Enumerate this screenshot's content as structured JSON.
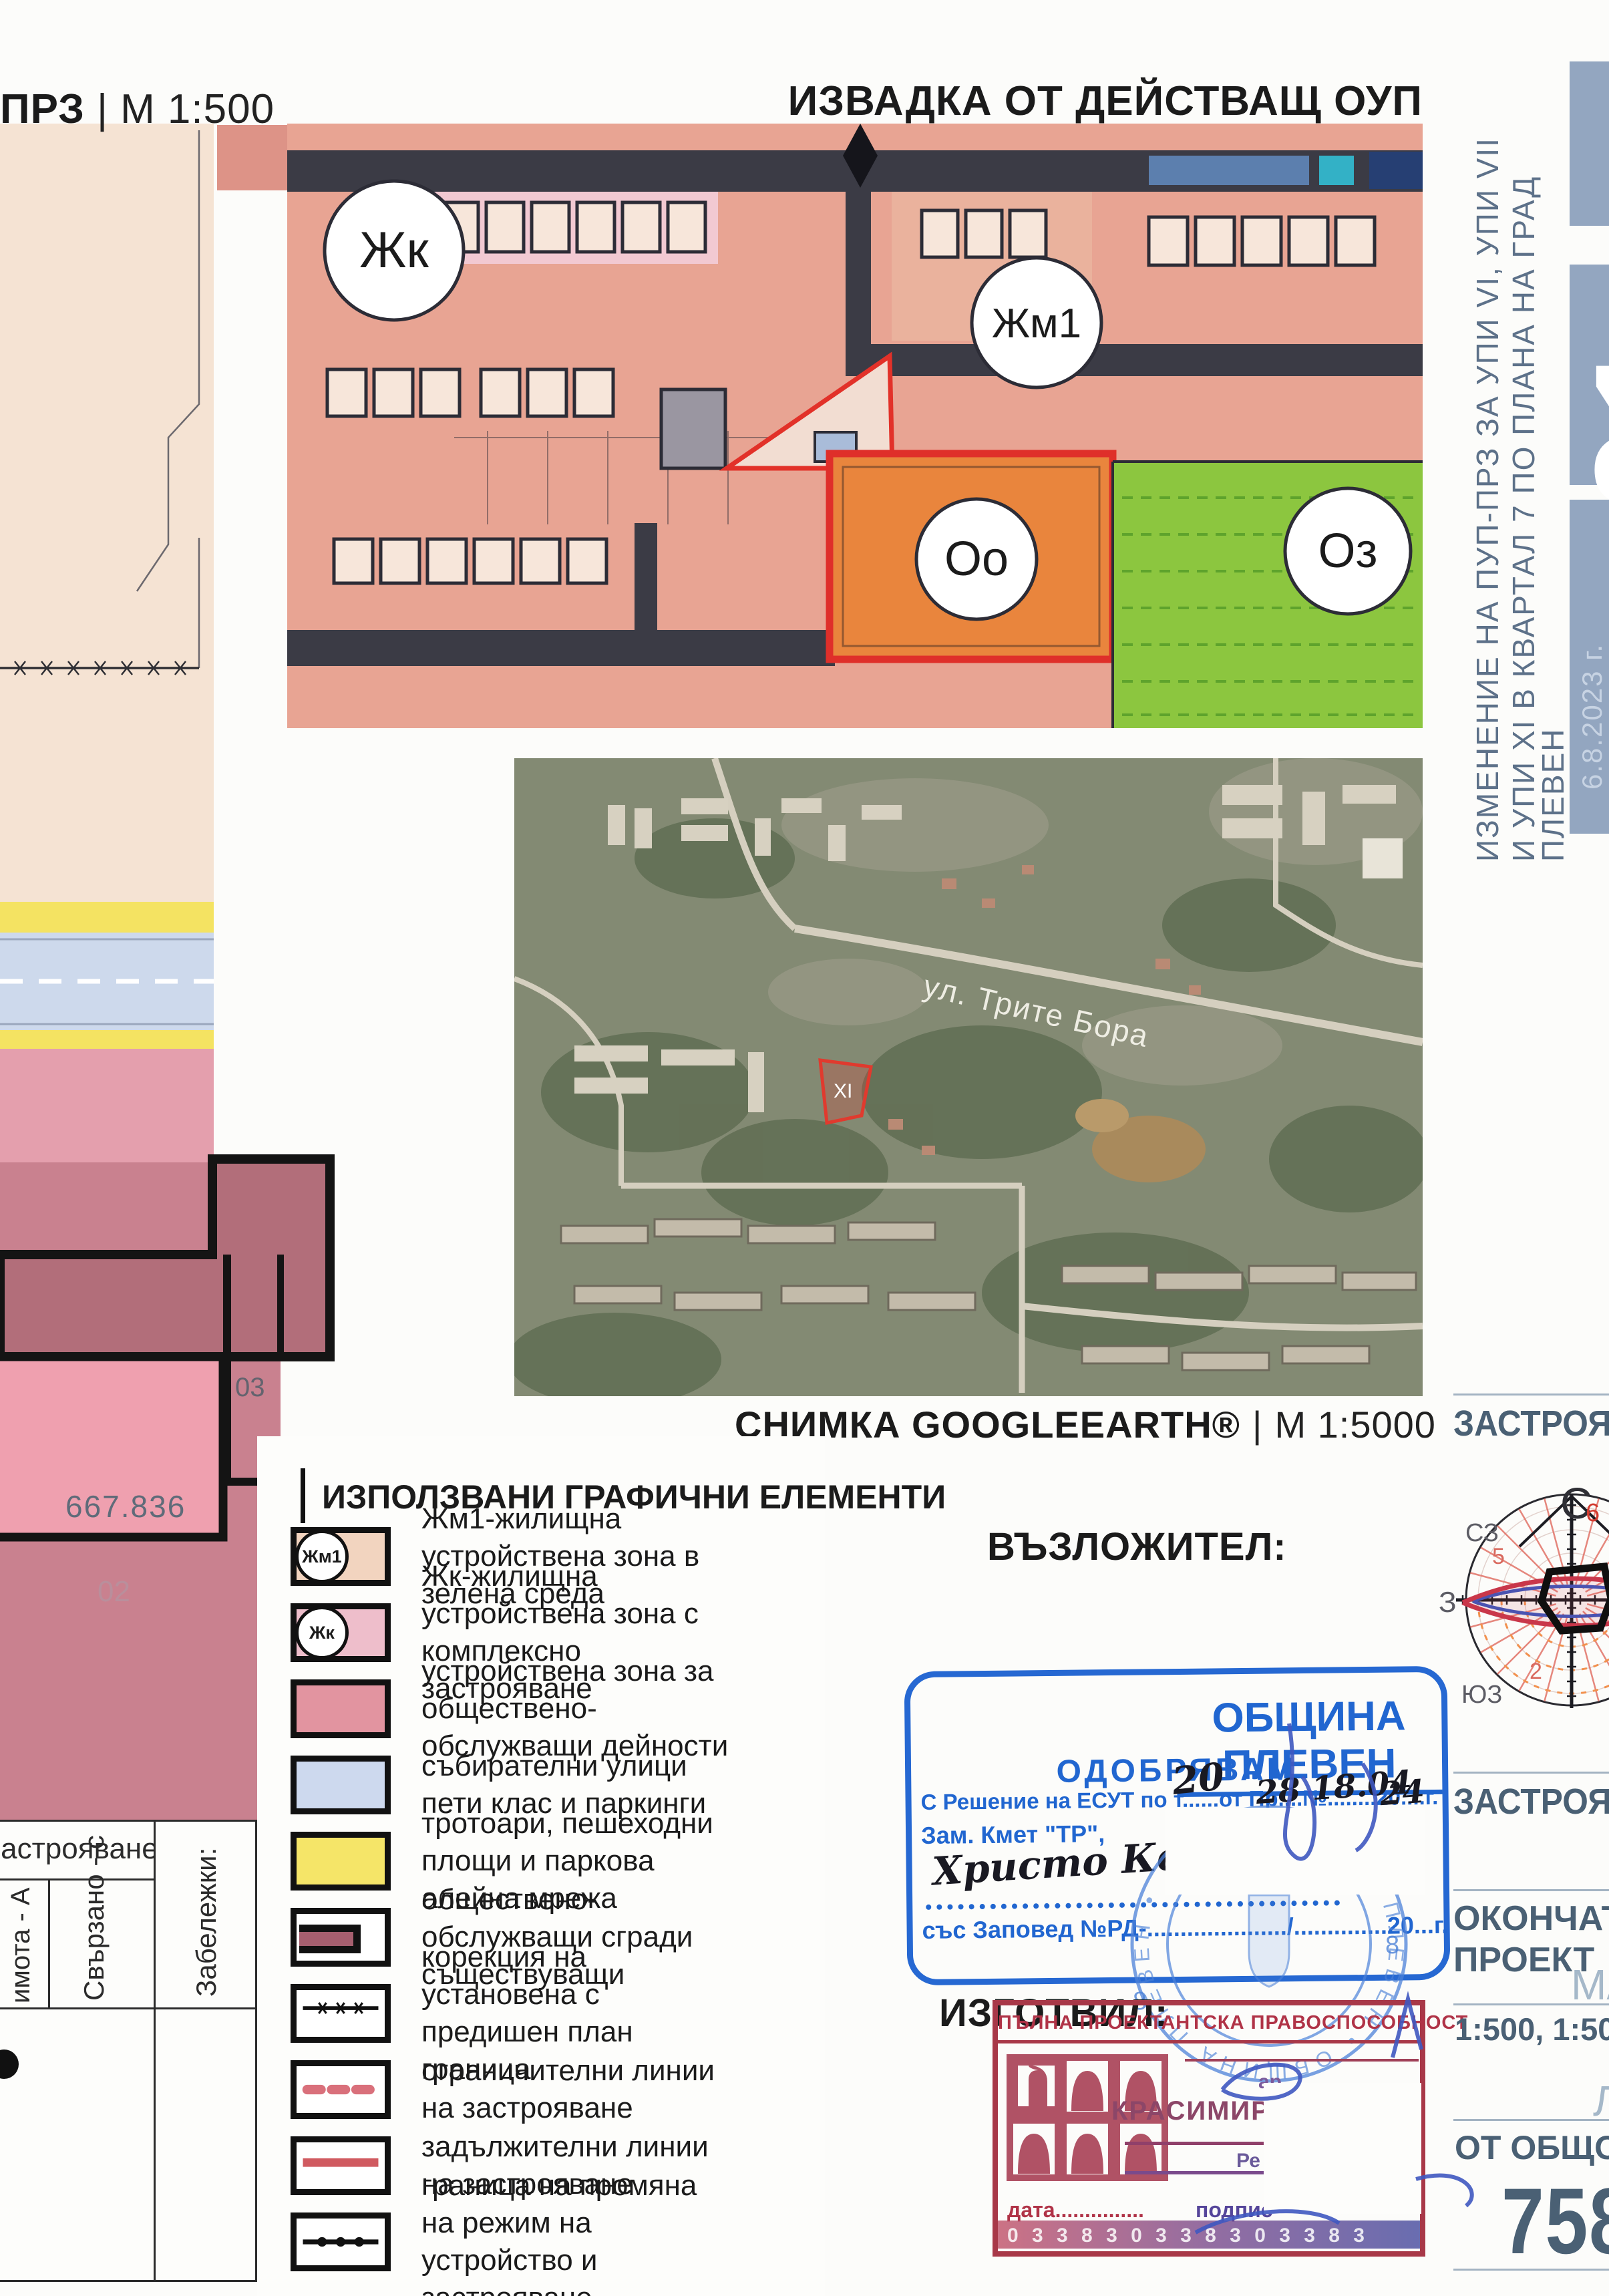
{
  "titles": {
    "plan": "ПРЗ",
    "plan_scale": "М 1:500",
    "sep": "|",
    "oup": "ИЗВАДКА ОТ ДЕЙСТВАЩ ОУП",
    "satellite": "СНИМКА GOOGLEEARTH®",
    "satellite_scale": "М 1:5000"
  },
  "oup_zones": {
    "zhk": "Жк",
    "zhm1": "Жм1",
    "oo": "Оо",
    "oz": "Оз"
  },
  "satellite": {
    "street": "ул. Трите Бора",
    "parcel": "XI"
  },
  "left_plan": {
    "area": "667.836",
    "p02": "02",
    "p03": "03"
  },
  "table": {
    "header": "застрояване",
    "col_a": "имота - А",
    "col_b": "Свързано - с",
    "notes": "Забележки:"
  },
  "sidebar": {
    "line1": "ИЗМЕНЕНИЕ НА ПУП-ПРЗ ЗА УПИ VI, УПИ VII",
    "line2": "И УПИ XI В КВАРТАЛ 7 ПО ПЛАНА НА ГРАД",
    "city": "ПЛЕВЕН",
    "sheet": "01",
    "date": "6.8.2023 г."
  },
  "legend": {
    "title": "ИЗПОЛЗВАНИ ГРАФИЧНИ ЕЛЕМЕНТИ",
    "items": [
      {
        "type": "zone-zhm1",
        "badge": "Жм1",
        "text": "Жм1-жилищна устройствена зона в зелена среда"
      },
      {
        "type": "zone-zhk",
        "badge": "Жк",
        "text": "Жк-жилищна устройствена зона с комплексно застрояване"
      },
      {
        "type": "zone-public",
        "text": "устройствена зона за обществено-обслужващи дейности"
      },
      {
        "type": "zone-street",
        "text": "събирателни улици пети клас и паркинги"
      },
      {
        "type": "zone-sidewalk",
        "text": "тротоари, пешеходни площи и паркова алейна мрежа"
      },
      {
        "type": "building",
        "text": "обществено-обслужващи сгради съществуващи"
      },
      {
        "type": "line-correction",
        "text": "корекция на установена с предишен план граница"
      },
      {
        "type": "line-restrict",
        "text": "ограничителни линии на застрояване"
      },
      {
        "type": "line-mandatory",
        "text": "задължителни линии на застрояване"
      },
      {
        "type": "line-regime",
        "text": "граница на промяна на режим на устройство и застрояване"
      }
    ]
  },
  "stamps": {
    "client_label": "ВЪЗЛОЖИТЕЛ:",
    "author_label": "ИЗГОТВИЛ:",
    "municipality": {
      "title": "ОБЩИНА ПЛЕВЕН",
      "approve": "ОДОБРЯВАМ",
      "line1": "С Решение на ЕСУТ по т......от Пр....№........20....г.",
      "line2": "Зам. Кмет \"ТР\",",
      "signature": "Христо Кочев",
      "line3": "със Заповед №РД-...................../..............20...г.",
      "hand1": "20",
      "hand2": "28 18.04",
      "hand3": "24",
      "seal_number": "8"
    },
    "architect": {
      "header": "ПЪЛНА ПРОЕКТАНТСКА ПРАВОСПОСОБНОСТ",
      "degree": "ар",
      "name": "КРАСИМИРО",
      "reg": "Ре",
      "date_label": "дата...............",
      "sign_label": "подпис",
      "serial": "0 3 3 8 3    0 3 3 8 3    0 3 3 8 3"
    }
  },
  "titleblock": {
    "section1": "ЗАСТРОЯВАНЕ",
    "section2": "ЗАСТРОЯВАНЕ",
    "phase1": "ОКОНЧАТЕЛЕН",
    "phase2": "ПРОЕКТ",
    "scale_label": "МАЩАБ",
    "scales": "1:500, 1:5000",
    "sheet_label": "ЛИСТ",
    "of_total": "ОТ ОБЩО: 1",
    "number": "758"
  },
  "compass": {
    "n": "С",
    "nw": "СЗ",
    "w": "З",
    "sw": "ЮЗ",
    "hour_top": "6",
    "hour_left": "5",
    "hour_bottom": "2"
  },
  "colors": {
    "stamp_blue": "#2668d2",
    "stamp_red": "#a83848",
    "slate_text": "#4a6074",
    "salmon_zone": "#e8a493",
    "green_zone": "#8cc63f",
    "orange_zone": "#e9853d",
    "pink_zone": "#e49fad",
    "road_blue": "#cdd9ec",
    "sidewalk_yellow": "#f4e362",
    "sidebar_grey": "#93a6c0"
  }
}
